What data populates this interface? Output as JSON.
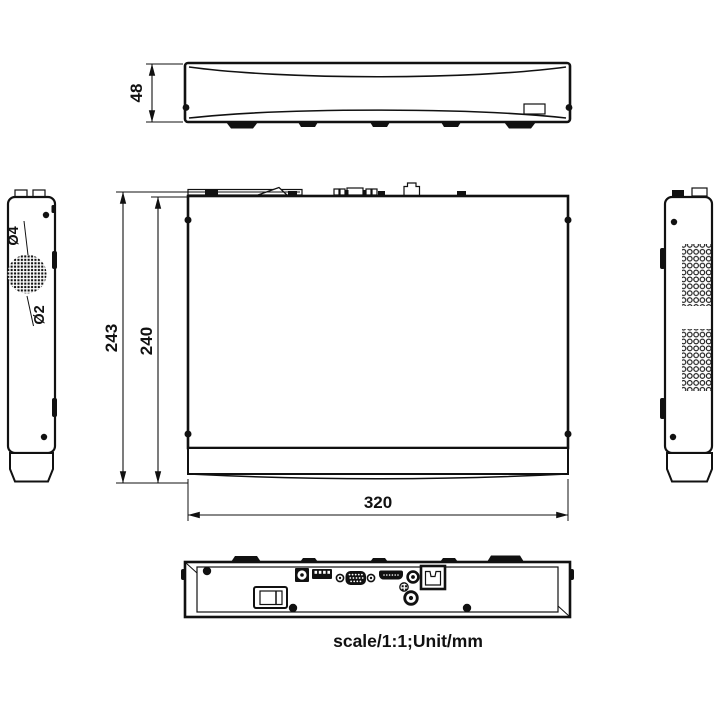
{
  "caption": "scale/1:1;Unit/mm",
  "dimensions": {
    "front_height": "48",
    "chassis_depth": "243",
    "body_depth": "240",
    "chassis_width": "320",
    "vent_hole_outer_dia": "Ø4",
    "vent_hole_inner_dia": "Ø2"
  },
  "colors": {
    "line": "#111111",
    "background": "#ffffff"
  }
}
